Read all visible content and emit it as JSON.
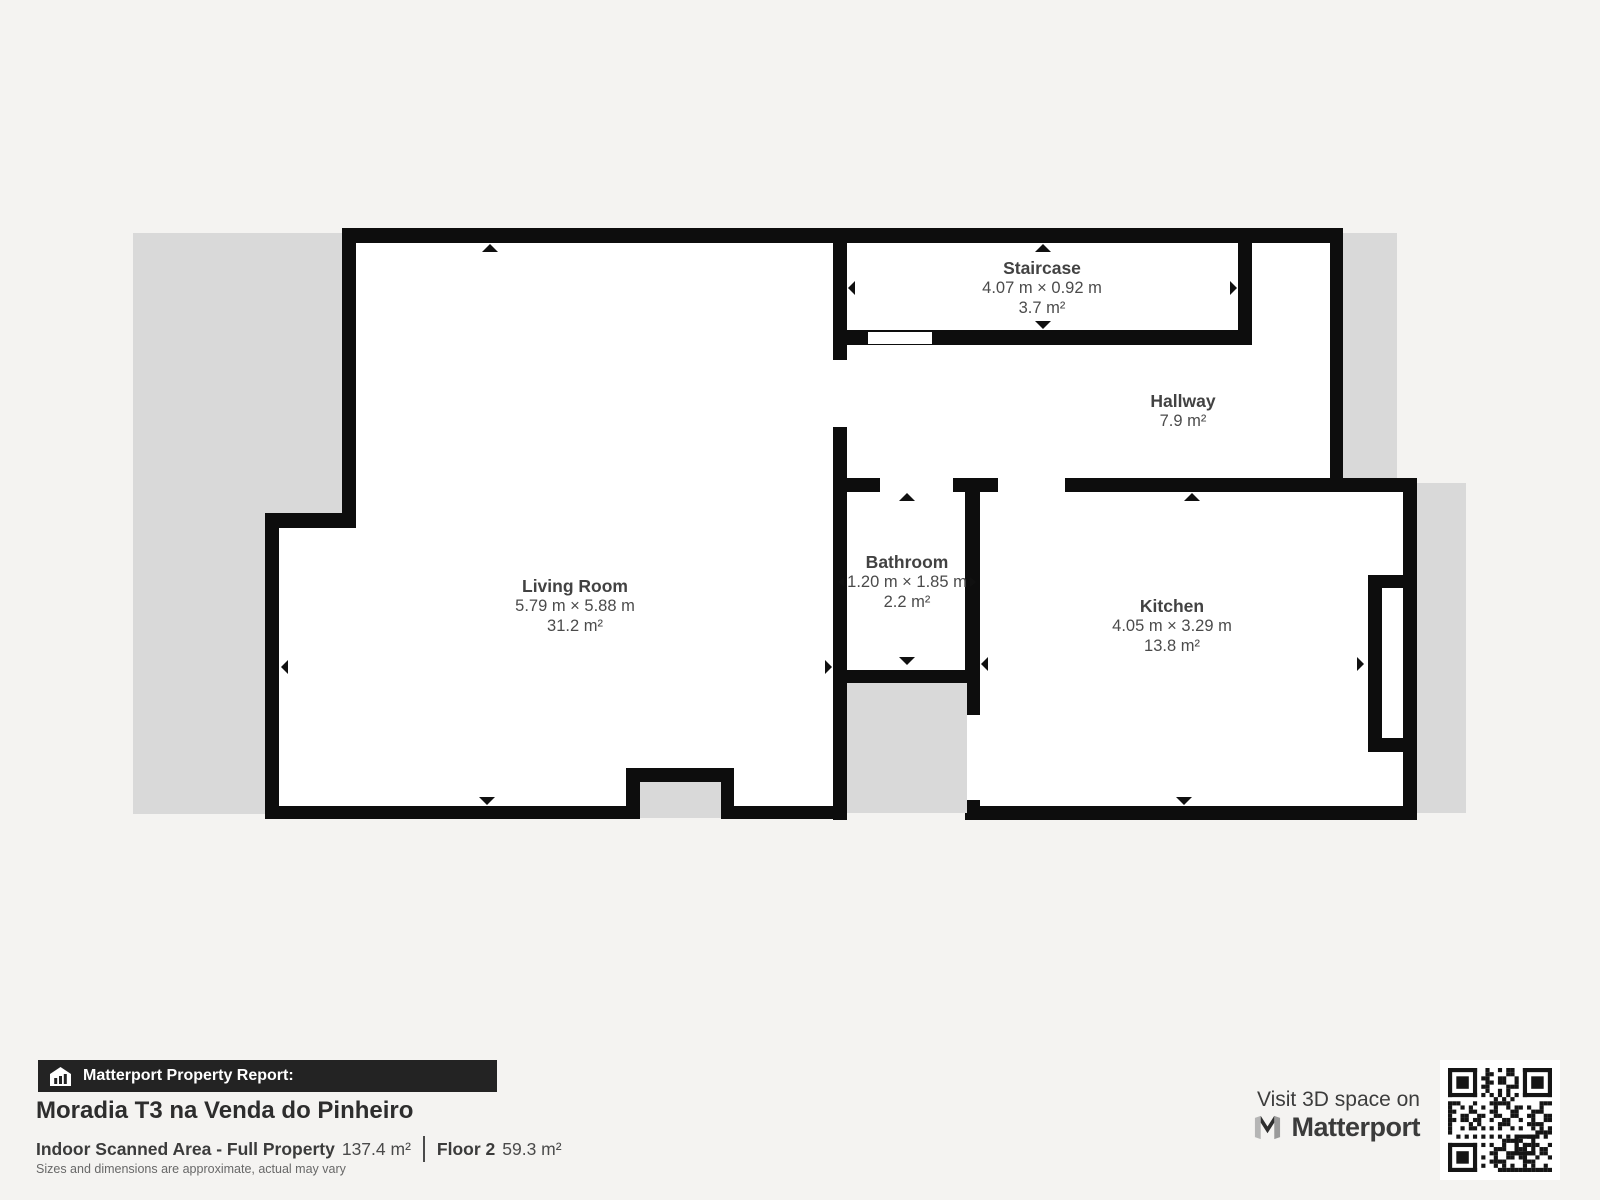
{
  "floorplan": {
    "rooms": [
      {
        "id": "living-room",
        "name": "Living Room",
        "dimensions": "5.79 m × 5.88 m",
        "area": "31.2 m²"
      },
      {
        "id": "staircase",
        "name": "Staircase",
        "dimensions": "4.07 m × 0.92 m",
        "area": "3.7 m²"
      },
      {
        "id": "hallway",
        "name": "Hallway",
        "area": "7.9 m²"
      },
      {
        "id": "bathroom",
        "name": "Bathroom",
        "dimensions": "1.20 m × 1.85 m",
        "area": "2.2 m²"
      },
      {
        "id": "kitchen",
        "name": "Kitchen",
        "dimensions": "4.05 m × 3.29 m",
        "area": "13.8 m²"
      }
    ],
    "colors": {
      "wall": "#0d0d0d",
      "floor": "#ffffff",
      "unscanned": "#d9d9d9",
      "page_background": "#f4f3f1"
    }
  },
  "footer": {
    "report_label": "Matterport Property Report:",
    "property_title": "Moradia T3 na Venda do Pinheiro",
    "scanned_area_label": "Indoor Scanned Area - Full Property",
    "scanned_area_value": "137.4 m²",
    "floor_label": "Floor 2",
    "floor_value": "59.3 m²",
    "disclaimer": "Sizes and dimensions are approximate, actual may vary"
  },
  "cta": {
    "visit_label": "Visit 3D space on",
    "brand_name": "Matterport"
  }
}
